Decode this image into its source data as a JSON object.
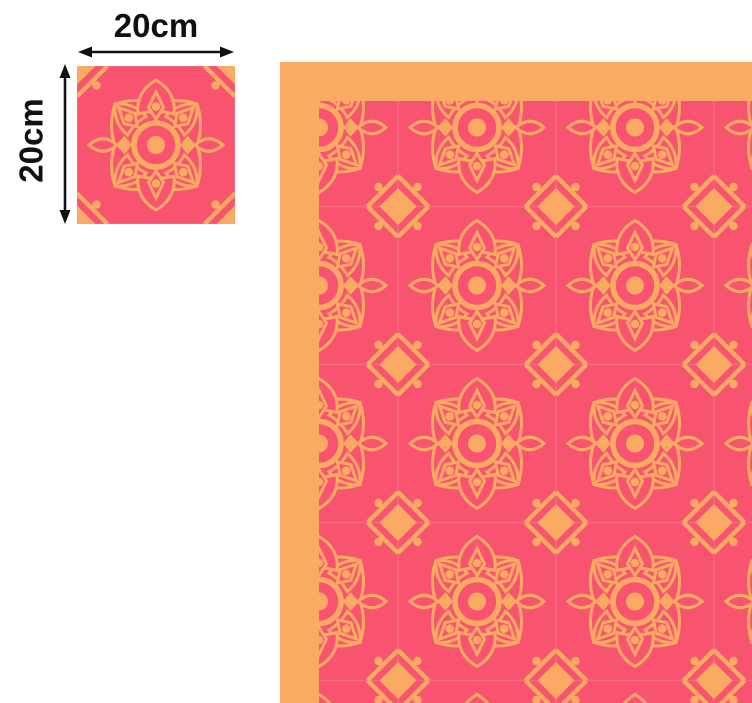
{
  "figure": {
    "type": "tile-size-illustration",
    "sample": {
      "width_label": "20cm",
      "height_label": "20cm"
    },
    "pattern_preview": {
      "description": "repeating mandala tile pattern with orange border on top and left",
      "tile_motifs": [
        "mandala-rosette",
        "corner-diamond",
        "corner-dots"
      ]
    },
    "colors": {
      "tile_pink": "#f8536f",
      "pattern_orange": "#fbaa64",
      "grout_pink": "#f96b7e",
      "annotation_ink": "#111111",
      "background": "#ffffff"
    }
  }
}
